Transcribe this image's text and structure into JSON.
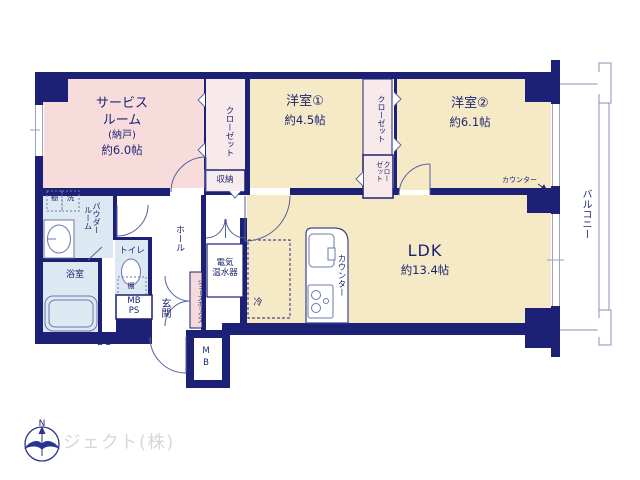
{
  "plan": {
    "rooms": {
      "service": {
        "line1": "サービス",
        "line2": "ルーム",
        "line3": "(納戸)",
        "size": "約6.0帖"
      },
      "western1": {
        "name": "洋室①",
        "size": "約4.5帖"
      },
      "western2": {
        "name": "洋室②",
        "size": "約6.1帖"
      },
      "ldk": {
        "name": "LDK",
        "size": "約13.4帖"
      },
      "bathroom": {
        "name": "浴室"
      },
      "toilet": {
        "name": "トイレ"
      },
      "powder_room": {
        "name": "パウダールーム"
      },
      "hall": {
        "name": "ホール"
      },
      "entrance": {
        "name": "玄関"
      },
      "balcony": {
        "name": "バルコニー"
      }
    },
    "storage": {
      "closet_service": "クローゼット",
      "closet_w1_upper": "クローゼット",
      "closet_w1_lower": "クローゼット",
      "shuno": "収納",
      "shoe_box": "シューズボックス",
      "shelf_powder": "棚",
      "washer": "洗",
      "shelf_toilet": "棚"
    },
    "labels": {
      "counter_kitchen": "カウンター",
      "counter_w2": "カウンター",
      "fridge": "冷",
      "water_heater": "電気\n温水器",
      "mb_ps": "MB\nPS",
      "mb": "MB",
      "ds": "DS"
    },
    "compass": {
      "north": "N"
    },
    "watermark": "ジェクト(株)",
    "colors": {
      "wall": "#1d2176",
      "room_cream": "#f6e9c6",
      "room_pink": "#f8dcdc",
      "closet_pink": "#f8eaea",
      "wet_blue": "#dde9f2",
      "shoebox_pink": "#f5d9dc",
      "text_navy": "#1c2470",
      "watermark_gray": "#d7d7db"
    }
  }
}
